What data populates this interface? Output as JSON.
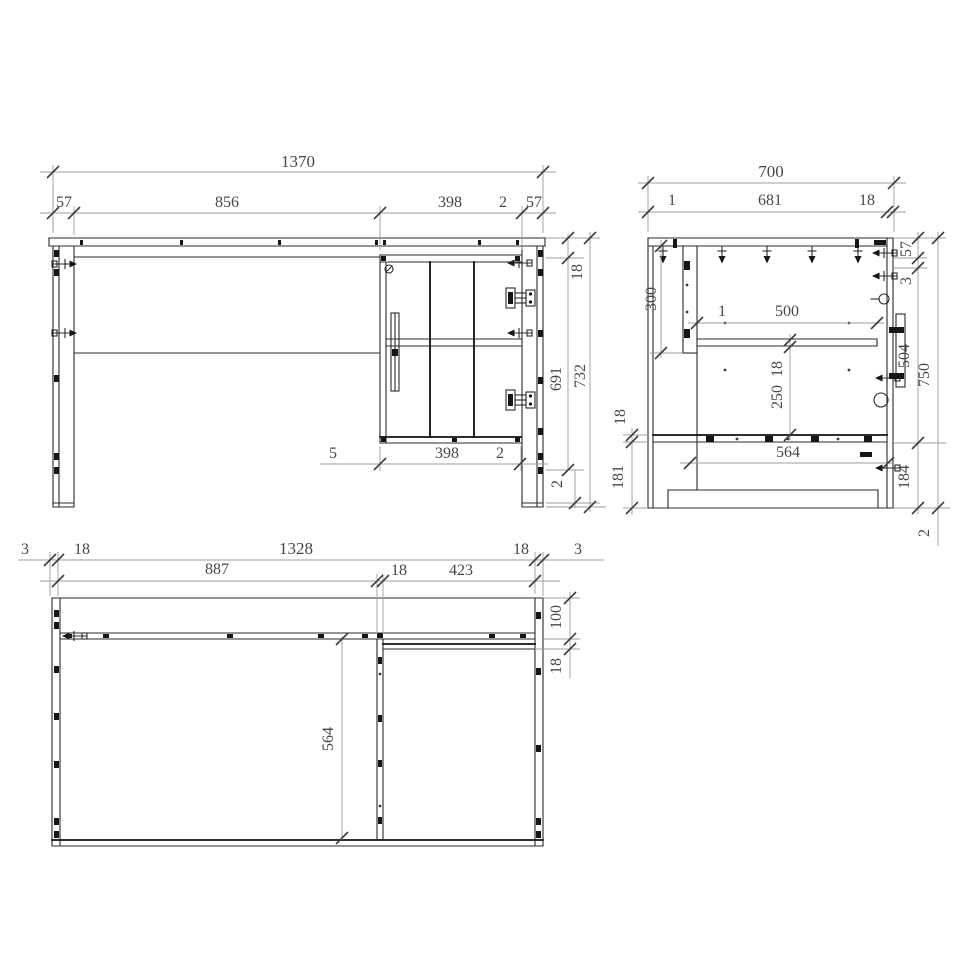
{
  "drawing": {
    "type": "furniture-technical-drawing",
    "background": "#ffffff",
    "line_color": "#2b2b2b",
    "dim_line_color": "#9c9c9c",
    "text_color": "#474747",
    "views": {
      "front": {
        "name": "front-elevation",
        "dims": {
          "total_width": "1370",
          "seg_left": "57",
          "seg_opening": "856",
          "seg_cabinet": "398",
          "seg_gap": "2",
          "seg_right": "57",
          "top_thickness": "18",
          "inner_height": "691",
          "body_height": "732",
          "bottom_gap": "2",
          "base_left": "5",
          "base_width": "398",
          "base_gap": "2"
        }
      },
      "side": {
        "name": "side-elevation",
        "dims": {
          "total_depth": "700",
          "front_edge": "1",
          "inner_depth": "681",
          "back_thickness": "18",
          "leg_height": "300",
          "shelf_front": "1",
          "shelf_depth": "500",
          "shelf_thickness": "18",
          "shelf_clear": "250",
          "bottom_depth": "564",
          "foot_thickness": "18",
          "foot_height": "181",
          "back_top": "57",
          "back_gap": "3",
          "slide_length": "504",
          "base_height": "184",
          "total_height": "750",
          "bottom_edge": "2"
        }
      },
      "plan": {
        "name": "top-plan",
        "dims": {
          "edge_left": "3",
          "panel_left": "18",
          "inner_width": "1328",
          "panel_right": "18",
          "edge_right": "3",
          "opening": "887",
          "partition": "18",
          "right_section": "423",
          "back_offset": "100",
          "shelf_edge": "18",
          "inner_depth": "564"
        }
      }
    }
  }
}
